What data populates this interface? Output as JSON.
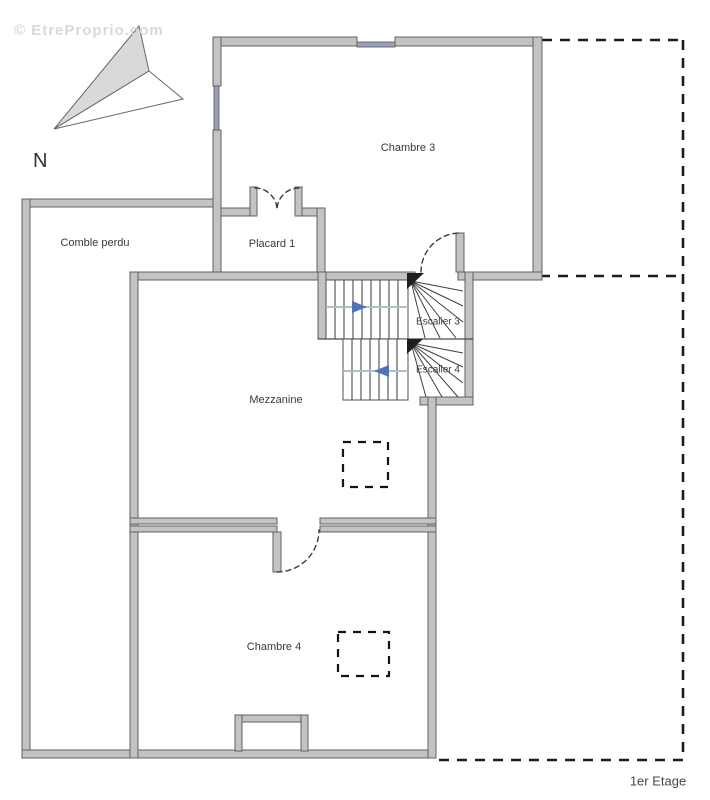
{
  "watermark": "© EtreProprio.com",
  "compass": {
    "icon": "north-arrow-icon",
    "label": "N"
  },
  "floor_label": "1er Etage",
  "rooms": [
    {
      "id": "chambre-3",
      "label": "Chambre 3"
    },
    {
      "id": "placard-1",
      "label": "Placard 1"
    },
    {
      "id": "comble-perdu",
      "label": "Comble perdu"
    },
    {
      "id": "mezzanine",
      "label": "Mezzanine"
    },
    {
      "id": "escalier-3",
      "label": "Escalier 3"
    },
    {
      "id": "escalier-4",
      "label": "Escalier 4"
    },
    {
      "id": "chambre-4",
      "label": "Chambre 4"
    }
  ],
  "colors": {
    "wall_fill": "#c3c3c3",
    "wall_stroke": "#606060",
    "dashed_boundary": "#1c1c1c",
    "stair_arrow_blue": "#4d74b5",
    "stair_guide": "#a9c0c6",
    "window_blue": "#9aa0b8",
    "text": "#3a3a3a",
    "watermark": "#d9d9d9"
  }
}
